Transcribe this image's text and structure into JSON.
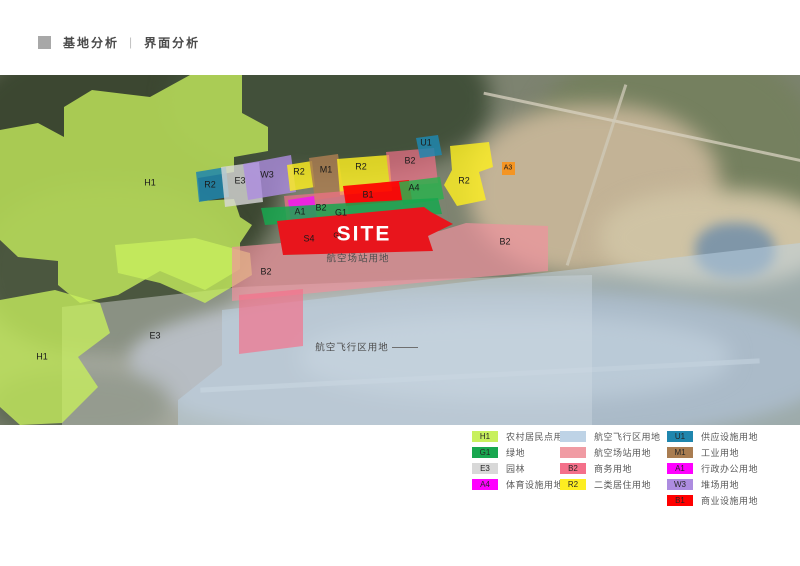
{
  "header": {
    "title_primary": "基地分析",
    "divider": "|",
    "title_secondary": "界面分析"
  },
  "colors": {
    "h1": "#c8f05e",
    "g1": "#18a74f",
    "e3": "#d8d8d8",
    "e3_overlay": "#e2e2e2",
    "a4_map": "#2db04e",
    "airfield": "#bed3e6",
    "station": "#f0919d",
    "b2": "#f4708a",
    "r2": "#fdee21",
    "u1": "#1f86ae",
    "m1": "#a97d51",
    "a1": "#f018f0",
    "w3": "#ad8ce0",
    "b1": "#ff0000",
    "site": "#e8151c",
    "a3": "#f7941d",
    "s4": "#a2a690"
  },
  "map": {
    "zone_labels": {
      "h1_main": "H1",
      "h1_lower": "H1",
      "e3_area": "E3",
      "b2_vertical": "B2",
      "r2_teal": "R2",
      "e3_parcel": "E3",
      "w3": "W3",
      "r2_small": "R2",
      "m1": "M1",
      "r2_mid": "R2",
      "b2_top": "B2",
      "u1": "U1",
      "r2_right": "R2",
      "a3": "A3",
      "a1": "A1",
      "b2_mid": "B2",
      "b1": "B1",
      "a4": "A4",
      "g1_strip": "G1",
      "s4": "S4",
      "g1_small": "G1",
      "b2_station": "B2",
      "site": "SITE",
      "station_band": "航空场站用地",
      "airfield_band": "航空飞行区用地"
    }
  },
  "legend": {
    "columns": [
      {
        "items": [
          {
            "code": "H1",
            "label": "农村居民点用地",
            "color": "#c8f05e"
          },
          {
            "code": "G1",
            "label": "绿地",
            "color": "#18a74f"
          },
          {
            "code": "E3",
            "label": "园林",
            "color": "#d8d8d8"
          },
          {
            "code": "A4",
            "label": "体育设施用地",
            "color": "#ff00ff"
          }
        ]
      },
      {
        "items": [
          {
            "code": "",
            "label": "航空飞行区用地",
            "color": "#bed3e6"
          },
          {
            "code": "",
            "label": "航空场站用地",
            "color": "#f09ba3"
          },
          {
            "code": "B2",
            "label": "商务用地",
            "color": "#f4708a"
          },
          {
            "code": "R2",
            "label": "二类居住用地",
            "color": "#fdee21"
          }
        ]
      },
      {
        "items": [
          {
            "code": "U1",
            "label": "供应设施用地",
            "color": "#1f86ae"
          },
          {
            "code": "M1",
            "label": "工业用地",
            "color": "#a97d51"
          },
          {
            "code": "A1",
            "label": "行政办公用地",
            "color": "#ff00ff"
          },
          {
            "code": "W3",
            "label": "堆场用地",
            "color": "#ad8ce0"
          },
          {
            "code": "B1",
            "label": "商业设施用地",
            "color": "#ff0000"
          }
        ]
      }
    ]
  }
}
